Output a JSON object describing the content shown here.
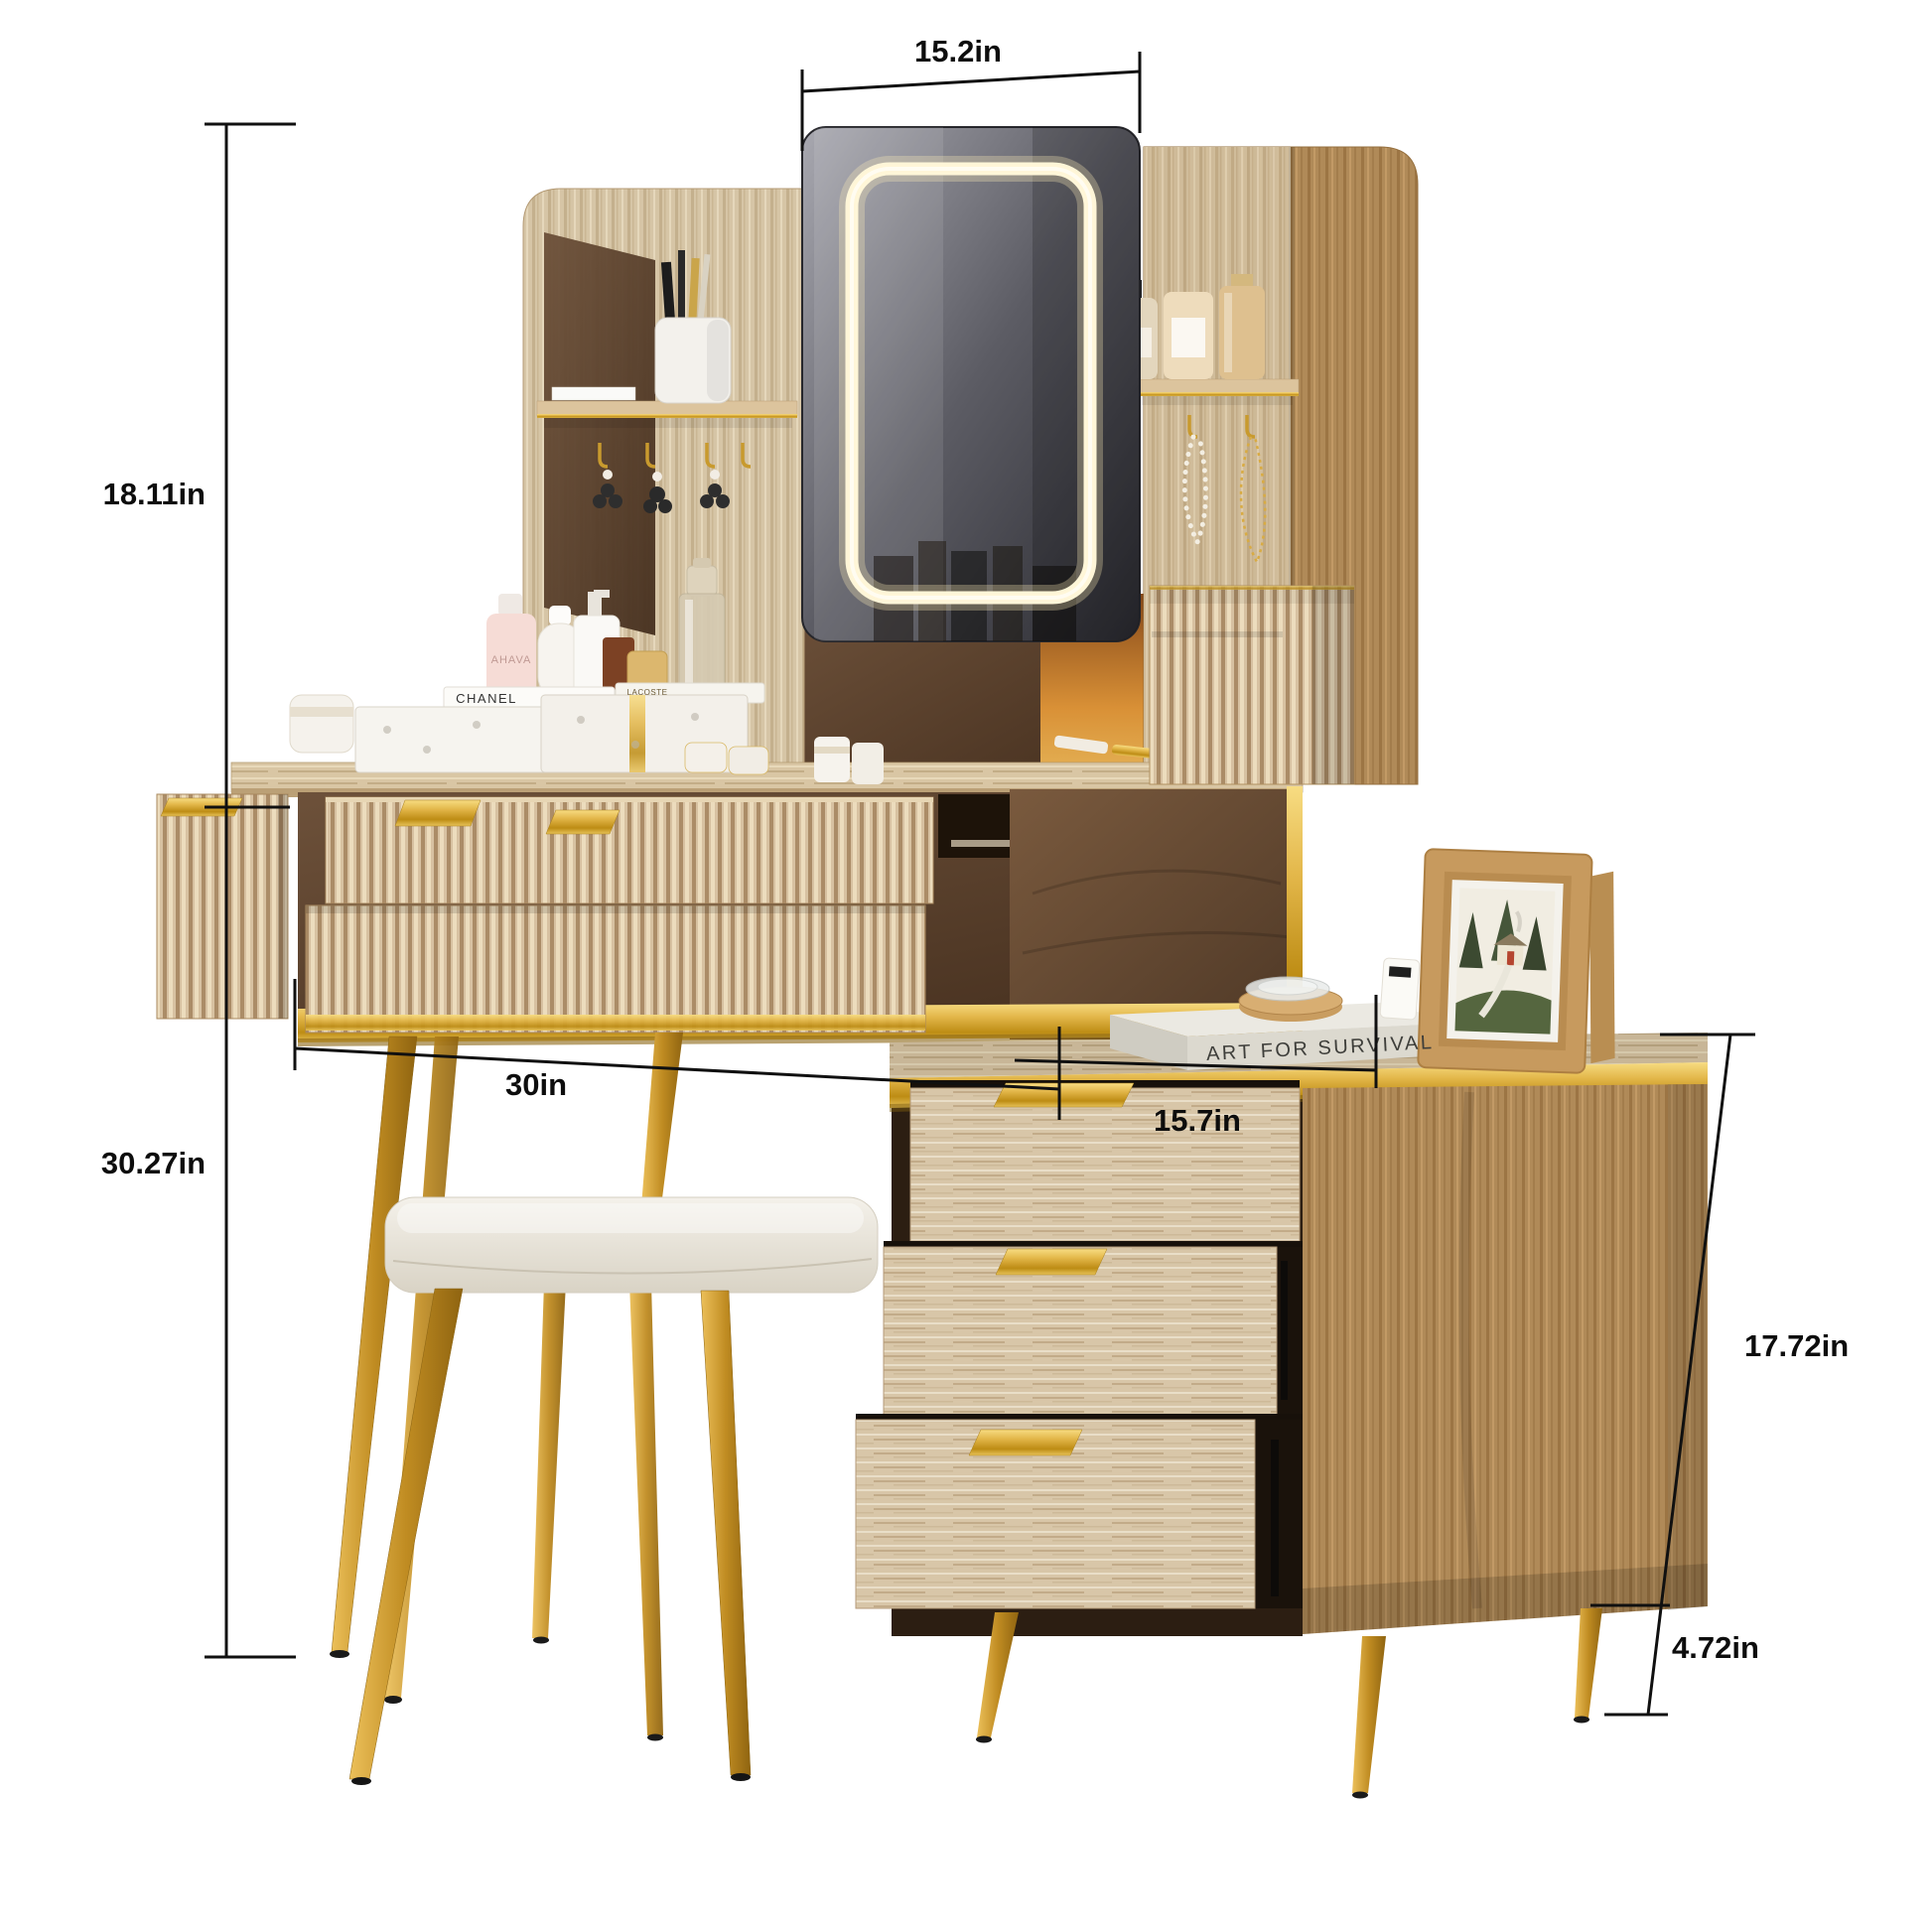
{
  "figure": {
    "type": "product-dimension-photo",
    "subject": "Vanity dressing table set with LED mirror hutch, fluted drawers, side cabinet and stool"
  },
  "dimensions": {
    "mirror_width": "15.2in",
    "hutch_height": "18.11in",
    "table_height": "30.27in",
    "table_width": "30in",
    "cabinet_depth": "15.7in",
    "cabinet_height": "17.72in",
    "cabinet_leg_height": "4.72in"
  },
  "visible_text": {
    "book_spine": "ART FOR SURVIVAL",
    "gift_box": "CHANEL",
    "perfume_bottle": "LACOSTE",
    "lotion_bottle": "AHAVA"
  },
  "colors": {
    "background": "#ffffff",
    "dimension_lines": "#101010",
    "gold_accent": "#d9a62e",
    "light_oak": "#d7c1a1",
    "whitewashed_oak": "#d8c6a8",
    "dark_walnut": "#5a4230",
    "led_glow": "#fff6d8",
    "cushion": "#efece3"
  }
}
